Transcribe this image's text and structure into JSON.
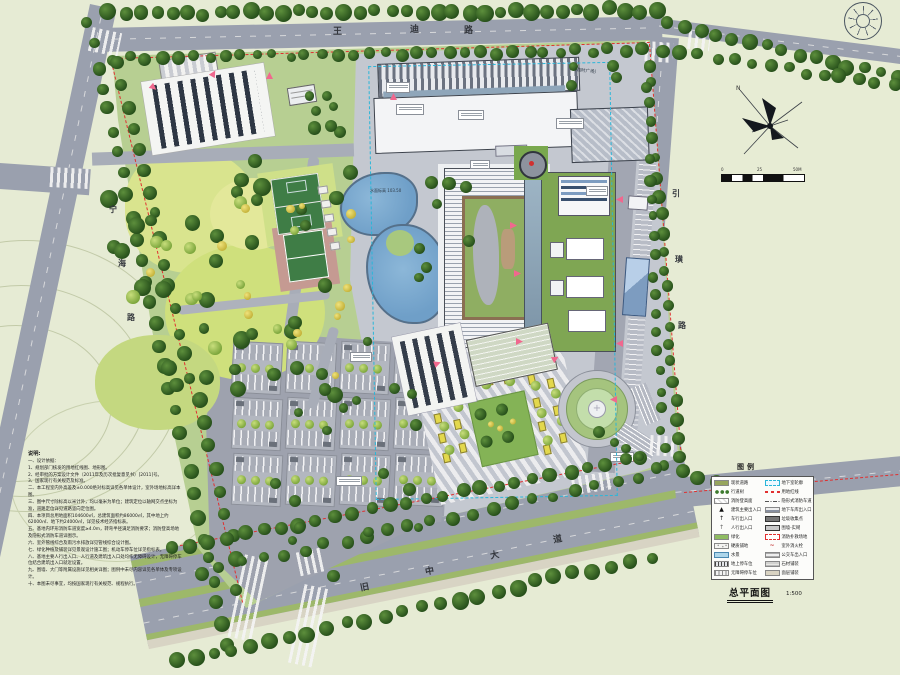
{
  "title": {
    "drawing_title": "总平面图",
    "scale": "1:500"
  },
  "roads": {
    "top": "王迪路",
    "left": "宁海路",
    "right": "引璜路",
    "bottom": "旧中大道"
  },
  "compass": {
    "north_label": "N"
  },
  "scalebar": {
    "labels": [
      "0",
      "25",
      "50M"
    ]
  },
  "annotations": {
    "temp_plaza": "（临时广场）",
    "pond_label": "水面标高 103.50"
  },
  "legend": {
    "title": "图例",
    "left": [
      "现状道路",
      "行道树",
      "消防登高面",
      "建筑主要出入口",
      "车行出入口",
      "人行出入口",
      "绿化",
      "硬质铺地",
      "水景",
      "地上停车位",
      "无障碍停车位"
    ],
    "right": [
      "地下室轮廓",
      "用地红线",
      "隐形式消防车道",
      "地下车库出入口",
      "垃圾收集点",
      "围墙-实砌",
      "消防扑救场地",
      "室外消火栓",
      "公交车出入口",
      "石材铺装",
      "面层铺装"
    ]
  },
  "notes": {
    "heading": "说明:",
    "lines": [
      "一、设计依据：",
      "1、规划部门核发的用地红线图、地形图。",
      "2、经审批的方案设计文件（2011年及历次批复意见书）[2011]号。",
      "3、国家现行有关规范及标准。",
      "二、本工程室内外高差及±0.000绝对标高详见各单体设计，室外场地标高详本图。",
      "三、图中尺寸除标高以米计外，均以毫米为单位；建筑定位以轴网交点坐标为准，道路定位详见道路竖向定位图。",
      "四、本项目总用地面积104600㎡，总建筑面积约86000㎡，其中地上约62000㎡、地下约24000㎡，详见技术经济指标表。",
      "五、基地内环形消防车道宽度≥4.0m，转弯半径满足消防要求；消防登高场地及隐形式消防车道详图示。",
      "六、室外管线综合及雨污水排放详见管线综合设计图。",
      "七、绿化种植及铺装详见景观设计施工图；机动车停车位详见指标表。",
      "八、基地主要人行出入口、人行道及建筑出入口处均作无障碍设计，无障碍停车位结合建筑出入口就近设置。",
      "九、围墙、大门等附属设施详见相关详图；图例中未尽内容详见各单体及专项设计。",
      "十、本图未尽事宜，均按国家现行有关规范、规程执行。"
    ]
  }
}
